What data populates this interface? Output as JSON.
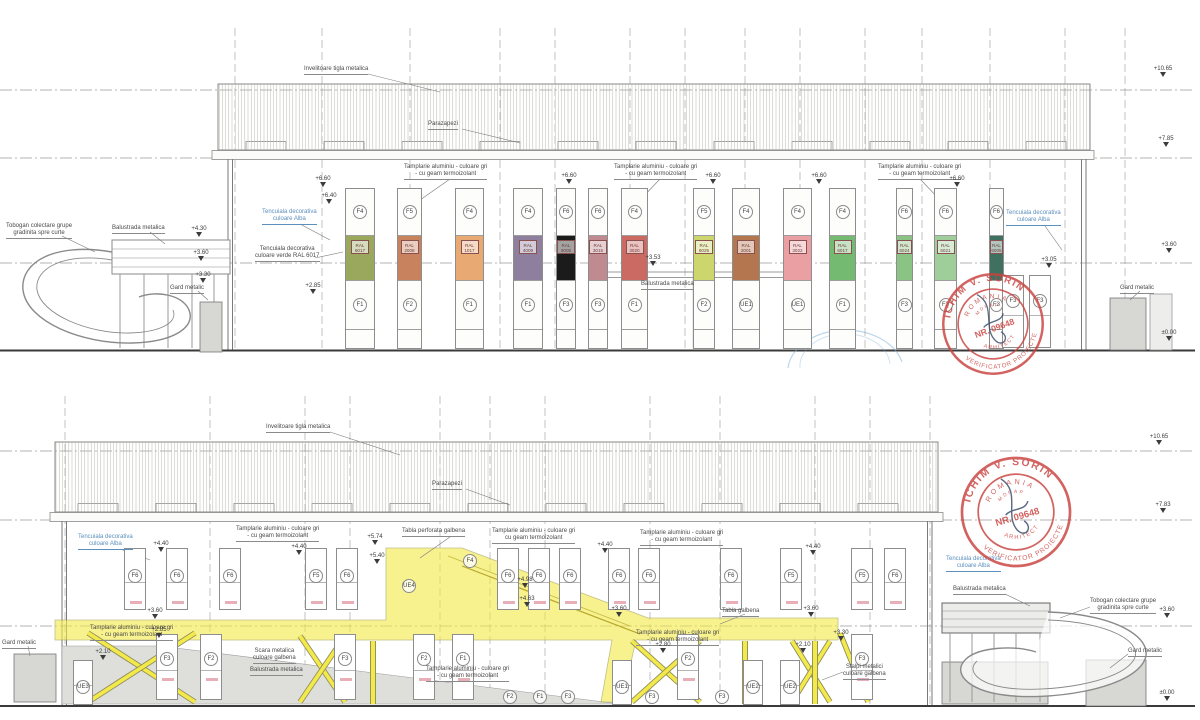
{
  "colors": {
    "highlight_yellow": "#f3e94a",
    "stamp_red": "#c9423e",
    "note_blue": "#5b8fbe",
    "panel_label_text": "#6e3d3d"
  },
  "stamp": {
    "name": "ICHIM V. SORIN",
    "country": "ROMANIA",
    "org": "MDRAP",
    "number": "NR. 09648",
    "title": "ARHITECT",
    "role": "VERIFICATOR PROIECTE"
  },
  "top_elevation": {
    "modules": [
      {
        "x": 345,
        "w": 30,
        "f_top": "F4",
        "ral": "RAL\n6017",
        "color": "#9aa85e",
        "f_bottom": "F1"
      },
      {
        "x": 397,
        "w": 25,
        "f_top": "F5",
        "ral": "RAL\n2008",
        "color": "#c8825d",
        "f_bottom": "F2"
      },
      {
        "x": 455,
        "w": 29,
        "f_top": "F4",
        "ral": "RAL\n1017",
        "color": "#e8a972",
        "f_bottom": "F1"
      },
      {
        "x": 513,
        "w": 30,
        "f_top": "F4",
        "ral": "RAL\n4009",
        "color": "#8d7f9d",
        "f_bottom": "F1"
      },
      {
        "x": 556,
        "w": 20,
        "f_top": "F6",
        "ral": "RAL\n9005",
        "color": "#1b1b1b",
        "f_bottom": "F3"
      },
      {
        "x": 588,
        "w": 20,
        "f_top": "F6",
        "ral": "RAL\n3015",
        "color": "#c08a91",
        "f_bottom": "F3"
      },
      {
        "x": 621,
        "w": 27,
        "f_top": "F4",
        "ral": "RAL\n3020",
        "color": "#cb6a63",
        "f_bottom": "F1"
      },
      {
        "x": 693,
        "w": 22,
        "f_top": "F5",
        "ral": "RAL\n6025",
        "color": "#ccd66d",
        "f_bottom": "F2"
      },
      {
        "x": 732,
        "w": 28,
        "f_top": "F4",
        "ral": "RAL\n2001",
        "color": "#b4764f",
        "f_bottom": "UE1"
      },
      {
        "x": 783,
        "w": 29,
        "f_top": "F4",
        "ral": "RAL\n3022",
        "color": "#ea9fa3",
        "f_bottom": "UE1"
      },
      {
        "x": 829,
        "w": 27,
        "f_top": "F4",
        "ral": "RAL\n6017",
        "color": "#74ba70",
        "f_bottom": "F1"
      },
      {
        "x": 896,
        "w": 17,
        "f_top": "F6",
        "ral": "RAL\n6024",
        "color": "#8ac384",
        "f_bottom": "F3"
      },
      {
        "x": 934,
        "w": 23,
        "f_top": "F6",
        "ral": "RAL\n6021",
        "color": "#9fce9a",
        "f_bottom": "F3"
      },
      {
        "x": 989,
        "w": 15,
        "f_top": "F6",
        "ral": "RAL\n6005",
        "color": "#40705f",
        "f_bottom": "F3"
      }
    ],
    "extra_windows": [
      {
        "x": 1013,
        "label": "F3"
      },
      {
        "x": 1040,
        "label": "F3"
      }
    ],
    "annotations": [
      {
        "t": "Invelitoare tigla metalica",
        "x": 304,
        "y": 66
      },
      {
        "t": "Parazapezi",
        "x": 428,
        "y": 121
      },
      {
        "t": "Tamplarie aluminiu - culoare gri\n- cu geam termoizolant",
        "x": 404,
        "y": 164
      },
      {
        "t": "Tamplarie aluminiu - culoare gri\n- cu geam termoizolant",
        "x": 614,
        "y": 164
      },
      {
        "t": "Tamplarie aluminiu - culoare gri\n- cu geam termoizolant",
        "x": 878,
        "y": 164
      },
      {
        "t": "Tencuiala decorativa\nculoare Alba",
        "x": 262,
        "y": 209,
        "c": "blue"
      },
      {
        "t": "Tencuiala decorativa\nculoare verde RAL 6017",
        "x": 255,
        "y": 246
      },
      {
        "t": "Tobogan colectare grupe\ngradinita spre curte",
        "x": 6,
        "y": 223
      },
      {
        "t": "Balustrada metalica",
        "x": 112,
        "y": 225
      },
      {
        "t": "Gard metalic",
        "x": 170,
        "y": 285
      },
      {
        "t": "Balustrada metalica",
        "x": 641,
        "y": 281
      },
      {
        "t": "Tencuiala decorativa\nculoare Alba",
        "x": 1006,
        "y": 210,
        "c": "blue"
      },
      {
        "t": "Gard metalic",
        "x": 1120,
        "y": 285
      }
    ],
    "marks": [
      {
        "t": "+10.65",
        "x": 1150,
        "y": 66
      },
      {
        "t": "+7.85",
        "x": 1153,
        "y": 136
      },
      {
        "t": "+3.60",
        "x": 1156,
        "y": 242
      },
      {
        "t": "±0.00",
        "x": 1156,
        "y": 330
      },
      {
        "t": "+6.60",
        "x": 310,
        "y": 176
      },
      {
        "t": "+6.40",
        "x": 316,
        "y": 193
      },
      {
        "t": "+6.60",
        "x": 556,
        "y": 173
      },
      {
        "t": "+6.60",
        "x": 700,
        "y": 173
      },
      {
        "t": "+6.60",
        "x": 806,
        "y": 173
      },
      {
        "t": "+6.60",
        "x": 944,
        "y": 176
      },
      {
        "t": "+4.30",
        "x": 186,
        "y": 226
      },
      {
        "t": "+3.60",
        "x": 188,
        "y": 250
      },
      {
        "t": "+3.30",
        "x": 190,
        "y": 272
      },
      {
        "t": "+3.53",
        "x": 640,
        "y": 255
      },
      {
        "t": "+3.05",
        "x": 1036,
        "y": 257
      },
      {
        "t": "+2.85",
        "x": 300,
        "y": 283
      }
    ],
    "grid_x": [
      235,
      322,
      410,
      500,
      555,
      630,
      685,
      745,
      800,
      865,
      922,
      990,
      1065,
      1125
    ],
    "datum_y": [
      90,
      158,
      263,
      350
    ]
  },
  "bottom_elevation": {
    "upper_windows": [
      {
        "x": 135,
        "label": "F6"
      },
      {
        "x": 177,
        "label": "F6"
      },
      {
        "x": 230,
        "label": "F6"
      },
      {
        "x": 316,
        "label": "F5"
      },
      {
        "x": 347,
        "label": "F6"
      },
      {
        "x": 508,
        "label": "F6"
      },
      {
        "x": 539,
        "label": "F6"
      },
      {
        "x": 570,
        "label": "F6"
      },
      {
        "x": 619,
        "label": "F6"
      },
      {
        "x": 649,
        "label": "F6"
      },
      {
        "x": 731,
        "label": "F6"
      },
      {
        "x": 791,
        "label": "F5"
      },
      {
        "x": 862,
        "label": "F5"
      },
      {
        "x": 895,
        "label": "F6"
      }
    ],
    "floating_circles": [
      {
        "x": 470,
        "y": 561,
        "label": "F4"
      },
      {
        "x": 409,
        "y": 586,
        "label": "UE4"
      }
    ],
    "lower_windows": [
      {
        "x": 167,
        "label": "F3"
      },
      {
        "x": 211,
        "label": "F2"
      },
      {
        "x": 345,
        "label": "F3"
      },
      {
        "x": 424,
        "label": "F2"
      },
      {
        "x": 463,
        "label": "F1"
      },
      {
        "x": 688,
        "label": "F2"
      },
      {
        "x": 862,
        "label": "F3"
      }
    ],
    "doors": [
      {
        "x": 83,
        "label": "UE3"
      },
      {
        "x": 622,
        "label": "UE1"
      },
      {
        "x": 753,
        "label": "UE2"
      },
      {
        "x": 790,
        "label": "UE2"
      }
    ],
    "floor_circles": [
      {
        "x": 510,
        "label": "F2"
      },
      {
        "x": 540,
        "label": "F1"
      },
      {
        "x": 568,
        "label": "F3"
      },
      {
        "x": 652,
        "label": "F3"
      },
      {
        "x": 722,
        "label": "F3"
      }
    ],
    "annotations": [
      {
        "t": "Invelitoare tigla metalica",
        "x": 266,
        "y": 424
      },
      {
        "t": "Parazapezi",
        "x": 432,
        "y": 481
      },
      {
        "t": "Tencuiala decorativa\nculoare Alba",
        "x": 78,
        "y": 534,
        "c": "blue"
      },
      {
        "t": "Tamplarie aluminiu - culoare gri\n- cu geam termoizolant",
        "x": 236,
        "y": 526
      },
      {
        "t": "Tabla perforata galbena",
        "x": 402,
        "y": 528
      },
      {
        "t": "Tamplarie aluminiu - culoare gri\ncu geam termoizolant",
        "x": 492,
        "y": 528
      },
      {
        "t": "Tamplarie aluminiu - culoare gri\n- cu geam termoizolant",
        "x": 640,
        "y": 530
      },
      {
        "t": "Tamplarie aluminiu - culoare gri\n- cu geam termoizolant",
        "x": 90,
        "y": 625
      },
      {
        "t": "Tamplarie aluminiu - culoare gri\n- cu geam termoizolant",
        "x": 426,
        "y": 666
      },
      {
        "t": "Tabla galbena",
        "x": 722,
        "y": 608
      },
      {
        "t": "Tamplarie aluminiu - culoare gri\n- cu geam termoizolant",
        "x": 636,
        "y": 630
      },
      {
        "t": "Scara metalica\nculoare galbena",
        "x": 253,
        "y": 648
      },
      {
        "t": "Balustrada metalica",
        "x": 250,
        "y": 667
      },
      {
        "t": "Stalpi metalici\nculoare galbena",
        "x": 843,
        "y": 664
      },
      {
        "t": "Balustrada metalica",
        "x": 953,
        "y": 586
      },
      {
        "t": "Tobogan colectare grupe\ngradinita spre curte",
        "x": 1090,
        "y": 598
      },
      {
        "t": "Gard metalic",
        "x": 1128,
        "y": 648
      },
      {
        "t": "Gard metalic",
        "x": 2,
        "y": 640
      },
      {
        "t": "Tencuiala decorativa\nculoare Alba",
        "x": 946,
        "y": 556,
        "c": "blue"
      }
    ],
    "marks": [
      {
        "t": "+10.65",
        "x": 1146,
        "y": 434
      },
      {
        "t": "+7.83",
        "x": 1150,
        "y": 502
      },
      {
        "t": "+3.60",
        "x": 1154,
        "y": 607
      },
      {
        "t": "±0.00",
        "x": 1154,
        "y": 690
      },
      {
        "t": "+4.40",
        "x": 148,
        "y": 541
      },
      {
        "t": "+4.40",
        "x": 286,
        "y": 544
      },
      {
        "t": "+5.74",
        "x": 362,
        "y": 534
      },
      {
        "t": "+5.40",
        "x": 364,
        "y": 553
      },
      {
        "t": "+4.98",
        "x": 512,
        "y": 577
      },
      {
        "t": "+4.63",
        "x": 514,
        "y": 596
      },
      {
        "t": "+4.40",
        "x": 592,
        "y": 542
      },
      {
        "t": "+4.40",
        "x": 800,
        "y": 544
      },
      {
        "t": "+3.60",
        "x": 142,
        "y": 608
      },
      {
        "t": "+2.85",
        "x": 146,
        "y": 627
      },
      {
        "t": "+2.10",
        "x": 90,
        "y": 649
      },
      {
        "t": "+3.60",
        "x": 606,
        "y": 606
      },
      {
        "t": "+3.60",
        "x": 798,
        "y": 606
      },
      {
        "t": "+3.30",
        "x": 828,
        "y": 630
      },
      {
        "t": "+2.80",
        "x": 650,
        "y": 642
      },
      {
        "t": "+2.10",
        "x": 790,
        "y": 642
      }
    ],
    "pink_marks_upper_x": [
      130,
      172,
      225,
      311,
      342,
      503,
      534,
      565,
      614,
      644,
      726,
      786,
      857,
      890
    ],
    "pink_marks_lower_x": [
      162,
      206,
      340,
      419,
      458,
      683,
      857
    ],
    "grid_x": [
      65,
      210,
      305,
      350,
      440,
      490,
      545,
      650,
      720,
      815,
      870,
      930
    ],
    "datum_y": [
      451,
      520,
      626,
      706
    ]
  }
}
